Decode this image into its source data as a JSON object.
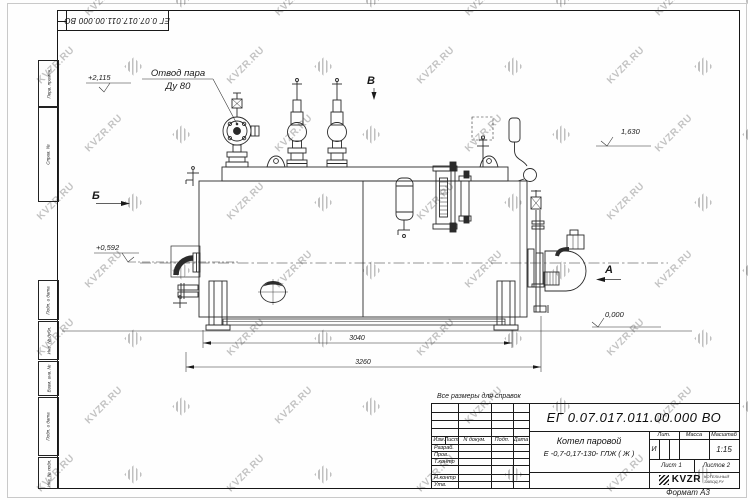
{
  "sheet": {
    "format_label": "Формат А3"
  },
  "watermark": {
    "text": "KVZR.RU"
  },
  "margin_labels": [
    "Перв. примен.",
    "Справ. №",
    "Подп. и дата",
    "Инв. № дубл.",
    "Взам. инв. №",
    "Подп. и дата",
    "Инв. № подл."
  ],
  "drawing": {
    "note": "Все размеры для справок",
    "callout": {
      "line1": "Отвод пара",
      "line2": "Ду 80"
    },
    "levels": {
      "steam_outlet": "+2,115",
      "gauge_top": "1,630",
      "burner_axis": "+0,592",
      "ground": "0,000"
    },
    "views": {
      "a": "А",
      "b": "Б",
      "v": "В"
    },
    "dims": {
      "inner": "3040",
      "overall": "3260"
    }
  },
  "title_block": {
    "doc_number": "ЕГ 0.07.017.011.00.000  ВО",
    "product_line1": "Котел паровой",
    "product_line2": "Е -0,7-0,17-130- ГЛЖ ( Ж )",
    "col_izm": "Изм",
    "col_list": "Лист",
    "col_ndok": "N докум.",
    "col_podp": "Подп.",
    "col_data": "Дата",
    "row_razrab": "Разраб.",
    "row_prov": "Пров.",
    "row_tkontr": "Т.контр",
    "row_nkontr": "Н.контр",
    "row_utv": "Утв.",
    "lit_label": "Лит.",
    "massa_label": "Масса",
    "masshtab_label": "Масштаб",
    "lit_value": "И",
    "scale": "1:15",
    "sheet_label": "Лист",
    "sheet_num": "1",
    "sheets_label": "Листов",
    "sheets_num": "2",
    "logo_text": "KVZR",
    "logo_sub1": "КОТЕЛЬНЫЙ",
    "logo_sub2": "ЗАВОД.РУ"
  }
}
